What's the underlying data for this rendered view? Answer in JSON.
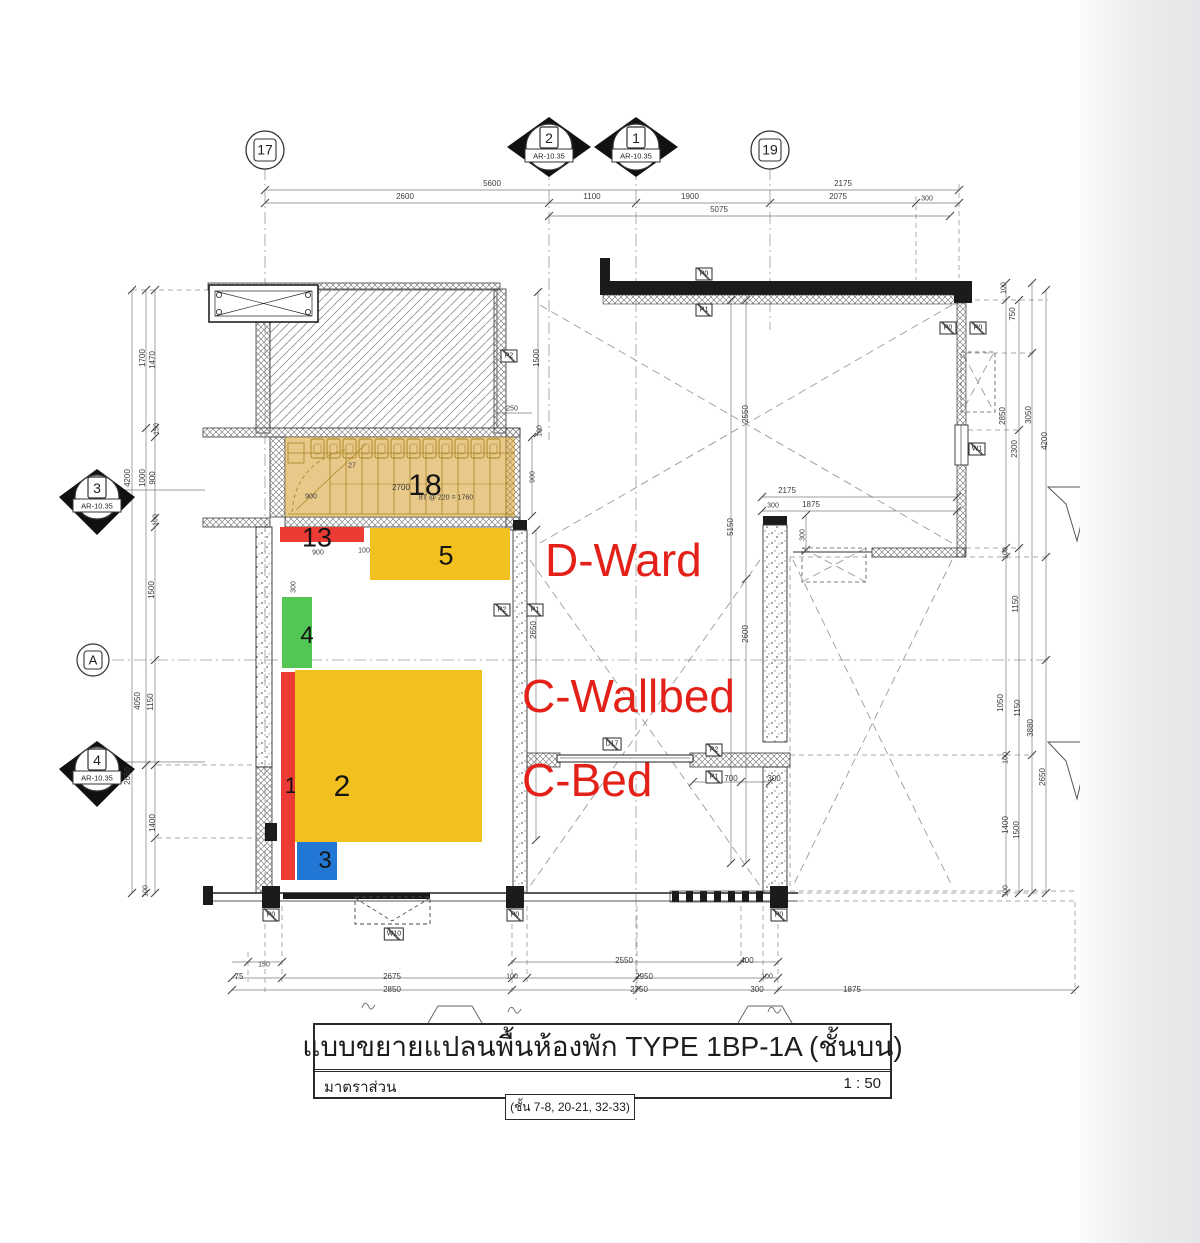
{
  "title_block": {
    "title": "แบบขยายแปลนพื้นห้องพัก TYPE 1BP-1A (ชั้นบน)",
    "scale_label": "มาตราส่วน",
    "scale_value": "1 : 50",
    "floors": "(ชั้น 7-8, 20-21, 32-33)"
  },
  "annotations": {
    "color": "#e32119",
    "ward": "D-Ward",
    "wallbed": "C-Wallbed",
    "bed": "C-Bed"
  },
  "bubbles": {
    "ref": "AR-10.35",
    "b17": {
      "label": "17"
    },
    "b19": {
      "label": "19"
    },
    "bA": {
      "label": "A"
    },
    "s2": {
      "label": "2"
    },
    "s1": {
      "label": "1"
    },
    "s3": {
      "label": "3"
    },
    "s4": {
      "label": "4"
    }
  },
  "overlays": [
    {
      "n": "18",
      "x": 285,
      "y": 437,
      "w": 230,
      "h": 80,
      "c": "rgba(213,156,40,0.55)",
      "lx": 425,
      "ly": 486,
      "fs": 30
    },
    {
      "n": "13",
      "x": 280,
      "y": 527,
      "w": 84,
      "h": 15,
      "c": "#EC3A35",
      "lx": 317,
      "ly": 538,
      "fs": 27
    },
    {
      "n": "5",
      "x": 370,
      "y": 528,
      "w": 140,
      "h": 52,
      "c": "#F2C120",
      "lx": 446,
      "ly": 556,
      "fs": 27
    },
    {
      "n": "4",
      "x": 282,
      "y": 597,
      "w": 30,
      "h": 71,
      "c": "#53C654",
      "lx": 307,
      "ly": 636,
      "fs": 24
    },
    {
      "n": "1",
      "x": 281,
      "y": 672,
      "w": 14,
      "h": 208,
      "c": "#EC3A35",
      "lx": 291,
      "ly": 786,
      "fs": 22
    },
    {
      "n": "2",
      "x": 295,
      "y": 670,
      "w": 187,
      "h": 172,
      "c": "#F2C120",
      "lx": 342,
      "ly": 787,
      "fs": 30
    },
    {
      "n": "3",
      "x": 297,
      "y": 842,
      "w": 40,
      "h": 38,
      "c": "#2277D4",
      "lx": 325,
      "ly": 861,
      "fs": 24
    }
  ],
  "dim_labels": [
    {
      "t": "5600",
      "x": 492,
      "y": 184
    },
    {
      "t": "2175",
      "x": 843,
      "y": 184
    },
    {
      "t": "2600",
      "x": 405,
      "y": 197
    },
    {
      "t": "1100",
      "x": 592,
      "y": 197
    },
    {
      "t": "1900",
      "x": 690,
      "y": 197
    },
    {
      "t": "2075",
      "x": 838,
      "y": 197
    },
    {
      "t": "300",
      "x": 927,
      "y": 199,
      "fs": 7
    },
    {
      "t": "5075",
      "x": 719,
      "y": 210
    },
    {
      "t": "1700",
      "x": 143,
      "y": 358,
      "r": 1
    },
    {
      "t": "1470",
      "x": 153,
      "y": 360,
      "r": 1
    },
    {
      "t": "150",
      "x": 157,
      "y": 429,
      "r": 1,
      "fs": 7
    },
    {
      "t": "4200",
      "x": 128,
      "y": 478,
      "r": 1
    },
    {
      "t": "1000",
      "x": 143,
      "y": 478,
      "r": 1
    },
    {
      "t": "900",
      "x": 153,
      "y": 478,
      "r": 1
    },
    {
      "t": "100",
      "x": 156,
      "y": 520,
      "r": 1,
      "fs": 7
    },
    {
      "t": "1500",
      "x": 152,
      "y": 590,
      "r": 1
    },
    {
      "t": "4050",
      "x": 138,
      "y": 701,
      "r": 1
    },
    {
      "t": "1150",
      "x": 151,
      "y": 702,
      "r": 1
    },
    {
      "t": "2650",
      "x": 128,
      "y": 776,
      "r": 1
    },
    {
      "t": "1400",
      "x": 153,
      "y": 823,
      "r": 1
    },
    {
      "t": "100",
      "x": 146,
      "y": 891,
      "r": 1,
      "fs": 7
    },
    {
      "t": "250",
      "x": 512,
      "y": 409,
      "fs": 7
    },
    {
      "t": "1500",
      "x": 537,
      "y": 358,
      "r": 1
    },
    {
      "t": "100",
      "x": 540,
      "y": 431,
      "r": 1,
      "fs": 7
    },
    {
      "t": "900",
      "x": 533,
      "y": 477,
      "r": 1,
      "fs": 7
    },
    {
      "t": "2700",
      "x": 401,
      "y": 488,
      "fs": 8
    },
    {
      "t": "8T @ 220 = 1760",
      "x": 446,
      "y": 498,
      "fs": 7
    },
    {
      "t": "900",
      "x": 311,
      "y": 497,
      "fs": 7
    },
    {
      "t": "27",
      "x": 352,
      "y": 466,
      "fs": 7
    },
    {
      "t": "900",
      "x": 318,
      "y": 553,
      "fs": 7
    },
    {
      "t": "100",
      "x": 364,
      "y": 551,
      "fs": 7
    },
    {
      "t": "300",
      "x": 294,
      "y": 587,
      "r": 1,
      "fs": 7
    },
    {
      "t": "2550",
      "x": 746,
      "y": 414,
      "r": 1
    },
    {
      "t": "5150",
      "x": 731,
      "y": 527,
      "r": 1
    },
    {
      "t": "2650",
      "x": 534,
      "y": 630,
      "r": 1
    },
    {
      "t": "2600",
      "x": 746,
      "y": 634,
      "r": 1
    },
    {
      "t": "2175",
      "x": 787,
      "y": 491
    },
    {
      "t": "1875",
      "x": 811,
      "y": 505
    },
    {
      "t": "300",
      "x": 773,
      "y": 506,
      "fs": 7
    },
    {
      "t": "300",
      "x": 803,
      "y": 535,
      "r": 1,
      "fs": 7
    },
    {
      "t": "700",
      "x": 731,
      "y": 779,
      "fs": 8
    },
    {
      "t": "300",
      "x": 774,
      "y": 779,
      "fs": 8
    },
    {
      "t": "100",
      "x": 1004,
      "y": 288,
      "r": 1,
      "fs": 7
    },
    {
      "t": "750",
      "x": 1013,
      "y": 314,
      "r": 1
    },
    {
      "t": "2850",
      "x": 1003,
      "y": 416,
      "r": 1
    },
    {
      "t": "3050",
      "x": 1029,
      "y": 415,
      "r": 1
    },
    {
      "t": "2300",
      "x": 1015,
      "y": 449,
      "r": 1
    },
    {
      "t": "4200",
      "x": 1045,
      "y": 441,
      "r": 1
    },
    {
      "t": "100",
      "x": 1006,
      "y": 553,
      "r": 1,
      "fs": 7
    },
    {
      "t": "1150",
      "x": 1016,
      "y": 604,
      "r": 1
    },
    {
      "t": "1050",
      "x": 1001,
      "y": 703,
      "r": 1
    },
    {
      "t": "1150",
      "x": 1018,
      "y": 708,
      "r": 1
    },
    {
      "t": "3880",
      "x": 1031,
      "y": 728,
      "r": 1
    },
    {
      "t": "2650",
      "x": 1043,
      "y": 777,
      "r": 1
    },
    {
      "t": "100",
      "x": 1006,
      "y": 758,
      "r": 1,
      "fs": 7
    },
    {
      "t": "1400",
      "x": 1006,
      "y": 825,
      "r": 1
    },
    {
      "t": "1500",
      "x": 1017,
      "y": 830,
      "r": 1
    },
    {
      "t": "100",
      "x": 1006,
      "y": 891,
      "r": 1,
      "fs": 7
    },
    {
      "t": "150",
      "x": 264,
      "y": 965,
      "fs": 7
    },
    {
      "t": "75",
      "x": 239,
      "y": 977,
      "fs": 8
    },
    {
      "t": "2675",
      "x": 392,
      "y": 977
    },
    {
      "t": "2850",
      "x": 392,
      "y": 990
    },
    {
      "t": "2550",
      "x": 624,
      "y": 961
    },
    {
      "t": "400",
      "x": 747,
      "y": 961,
      "fs": 8
    },
    {
      "t": "100",
      "x": 512,
      "y": 977,
      "fs": 7
    },
    {
      "t": "2950",
      "x": 644,
      "y": 977
    },
    {
      "t": "100",
      "x": 767,
      "y": 977,
      "fs": 7
    },
    {
      "t": "2750",
      "x": 639,
      "y": 990
    },
    {
      "t": "300",
      "x": 757,
      "y": 990,
      "fs": 8
    },
    {
      "t": "1875",
      "x": 852,
      "y": 990
    }
  ],
  "boxed_labels": [
    {
      "t": "P0",
      "x": 704,
      "y": 274
    },
    {
      "t": "P1",
      "x": 704,
      "y": 310
    },
    {
      "t": "P0",
      "x": 948,
      "y": 328
    },
    {
      "t": "P0",
      "x": 978,
      "y": 328
    },
    {
      "t": "P2",
      "x": 509,
      "y": 356
    },
    {
      "t": "W1",
      "x": 977,
      "y": 449
    },
    {
      "t": "P2",
      "x": 502,
      "y": 610
    },
    {
      "t": "P1",
      "x": 535,
      "y": 610
    },
    {
      "t": "D17",
      "x": 612,
      "y": 744
    },
    {
      "t": "P2",
      "x": 714,
      "y": 750
    },
    {
      "t": "P1",
      "x": 714,
      "y": 777
    },
    {
      "t": "P0",
      "x": 271,
      "y": 915
    },
    {
      "t": "P0",
      "x": 515,
      "y": 915
    },
    {
      "t": "P0",
      "x": 779,
      "y": 915
    },
    {
      "t": "W10",
      "x": 394,
      "y": 934
    }
  ]
}
